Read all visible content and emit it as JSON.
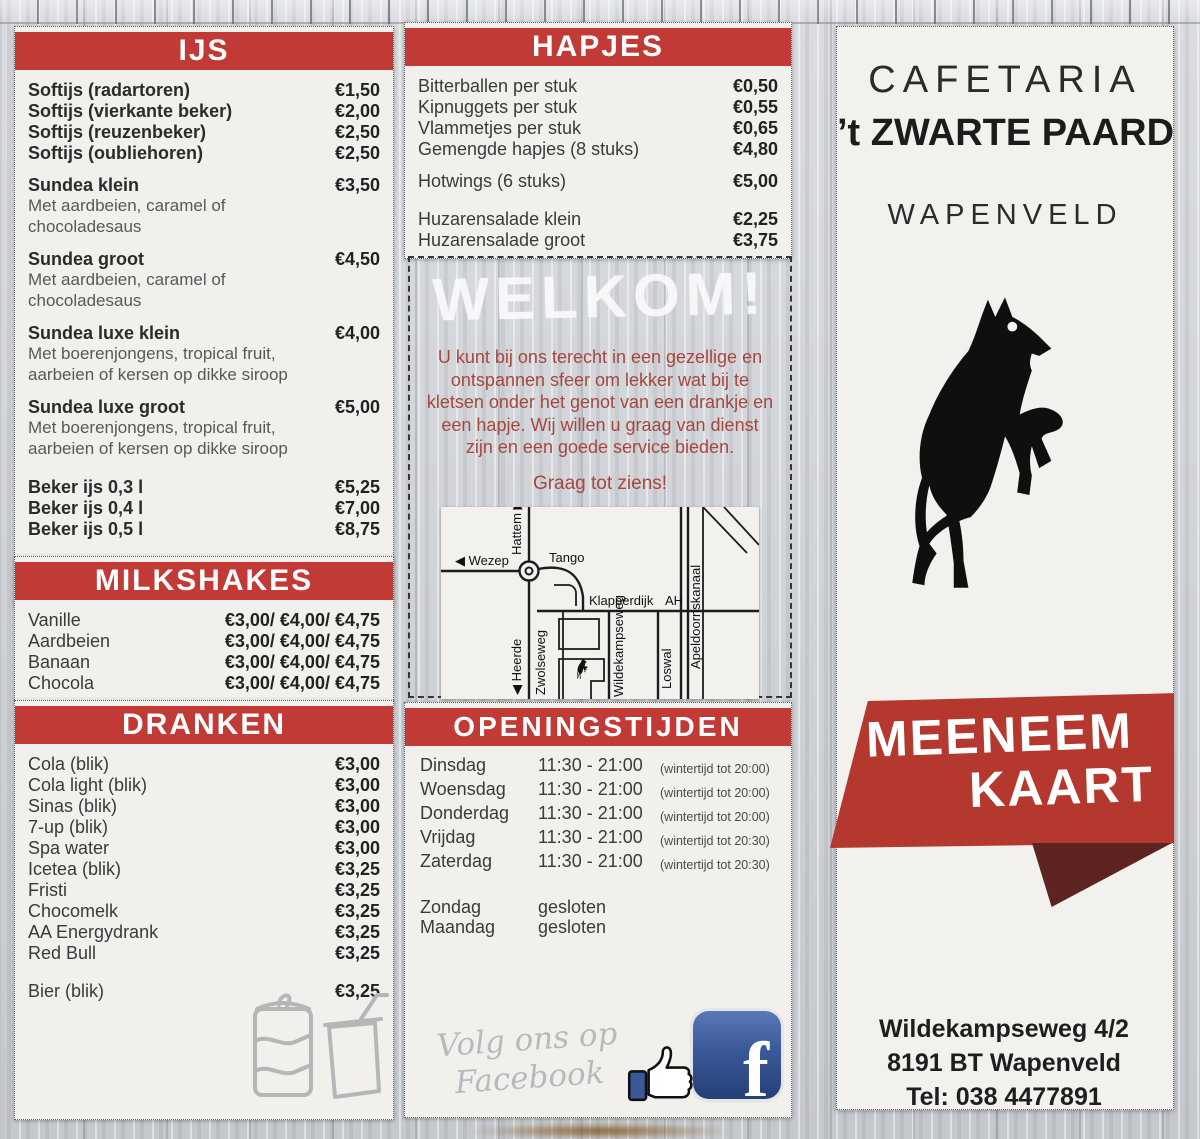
{
  "colors": {
    "header_red": "#c23a36",
    "banner_red": "#b5382f",
    "banner_fold": "#5e2421",
    "welkom_text_red": "#a6473f",
    "facebook_blue": "#3b5998"
  },
  "left": {
    "ijs": {
      "title": "IJS",
      "items": [
        {
          "name": "Softijs (radartoren)",
          "price": "€1,50"
        },
        {
          "name": "Softijs (vierkante beker)",
          "price": "€2,00"
        },
        {
          "name": "Softijs (reuzenbeker)",
          "price": "€2,50"
        },
        {
          "name": "Softijs (oubliehoren)",
          "price": "€2,50"
        },
        {
          "name": "Sundea klein",
          "price": "€3,50",
          "desc": "Met aardbeien, caramel of chocoladesaus",
          "gap": true
        },
        {
          "name": "Sundea groot",
          "price": "€4,50",
          "desc": "Met aardbeien, caramel of chocoladesaus",
          "gap": true
        },
        {
          "name": "Sundea luxe klein",
          "price": "€4,00",
          "desc": "Met boerenjongens, tropical fruit, aarbeien of kersen op dikke siroop",
          "gap": true
        },
        {
          "name": "Sundea luxe groot",
          "price": "€5,00",
          "desc": "Met boerenjongens, tropical fruit, aarbeien of kersen op dikke siroop",
          "gap": true
        },
        {
          "name": "Beker ijs 0,3 l",
          "price": "€5,25",
          "gap2": true
        },
        {
          "name": "Beker ijs 0,4 l",
          "price": "€7,00"
        },
        {
          "name": "Beker ijs 0,5 l",
          "price": "€8,75"
        },
        {
          "name": "Slagroom",
          "price": "€0,75",
          "gap2": true
        },
        {
          "name": "Spikkels/ nootjes/ chocodip",
          "price": "€0,50"
        }
      ]
    },
    "milkshakes": {
      "title": "MILKSHAKES",
      "items": [
        {
          "name": "Vanille",
          "price": "€3,00/ €4,00/ €4,75"
        },
        {
          "name": "Aardbeien",
          "price": "€3,00/ €4,00/ €4,75"
        },
        {
          "name": "Banaan",
          "price": "€3,00/ €4,00/ €4,75"
        },
        {
          "name": "Chocola",
          "price": "€3,00/ €4,00/ €4,75"
        }
      ]
    },
    "dranken": {
      "title": "DRANKEN",
      "items": [
        {
          "name": "Cola (blik)",
          "price": "€3,00"
        },
        {
          "name": "Cola light (blik)",
          "price": "€3,00"
        },
        {
          "name": "Sinas (blik)",
          "price": "€3,00"
        },
        {
          "name": "7-up (blik)",
          "price": "€3,00"
        },
        {
          "name": "Spa water",
          "price": "€3,00"
        },
        {
          "name": "Icetea (blik)",
          "price": "€3,25"
        },
        {
          "name": "Fristi",
          "price": "€3,25"
        },
        {
          "name": "Chocomelk",
          "price": "€3,25"
        },
        {
          "name": "AA Energydrank",
          "price": "€3,25"
        },
        {
          "name": "Red Bull",
          "price": "€3,25"
        },
        {
          "name": "Bier (blik)",
          "price": "€3,25",
          "gap2": true
        }
      ]
    }
  },
  "middle": {
    "hapjes": {
      "title": "HAPJES",
      "items": [
        {
          "name": "Bitterballen per stuk",
          "price": "€0,50"
        },
        {
          "name": "Kipnuggets per stuk",
          "price": "€0,55"
        },
        {
          "name": "Vlammetjes per stuk",
          "price": "€0,65"
        },
        {
          "name": "Gemengde hapjes (8 stuks)",
          "price": "€4,80"
        },
        {
          "name": "Hotwings (6 stuks)",
          "price": "€5,00",
          "gap": true
        },
        {
          "name": "Huzarensalade klein",
          "price": "€2,25",
          "gap2": true
        },
        {
          "name": "Huzarensalade groot",
          "price": "€3,75"
        }
      ]
    },
    "welkom": {
      "title": "WELKOM!",
      "body": "U kunt bij ons terecht in een gezellige en ontspannen sfeer om lekker wat bij te kletsen onder het genot van een drankje en een hapje. Wij willen u graag van dienst zijn en een goede service bieden.",
      "closing": "Graag tot ziens!"
    },
    "map": {
      "labels": {
        "hattem": "Hattem ▶",
        "wezep": "◀ Wezep",
        "tango": "Tango",
        "klapperdijk": "Klapperdijk",
        "ah": "AH",
        "apeldoornskanaal": "Apeldoornskanaal",
        "heerde": "◀ Heerde",
        "zwolseweg": "Zwolseweg",
        "wildekampseweg": "Wildekampseweg",
        "loswal": "Loswal"
      }
    },
    "openingstijden": {
      "title": "OPENINGSTIJDEN",
      "rows": [
        {
          "day": "Dinsdag",
          "time": "11:30 - 21:00",
          "note": "(wintertijd tot 20:00)"
        },
        {
          "day": "Woensdag",
          "time": "11:30 - 21:00",
          "note": "(wintertijd tot 20:00)"
        },
        {
          "day": "Donderdag",
          "time": "11:30 - 21:00",
          "note": "(wintertijd tot 20:00)"
        },
        {
          "day": "Vrijdag",
          "time": "11:30 - 21:00",
          "note": "(wintertijd tot 20:30)"
        },
        {
          "day": "Zaterdag",
          "time": "11:30 - 21:00",
          "note": "(wintertijd tot 20:30)"
        },
        {
          "day": "Zondag",
          "time": "gesloten",
          "gap2": true
        },
        {
          "day": "Maandag",
          "time": "gesloten"
        }
      ]
    },
    "facebook": {
      "line1": "Volg ons op",
      "line2": "Facebook",
      "icon_letter": "f"
    }
  },
  "right": {
    "header": {
      "line1": "CAFETARIA",
      "line2": "’t ZWARTE PAARD",
      "line3": "WAPENVELD"
    },
    "banner": {
      "line1": "MEENEEM",
      "line2": "KAART"
    },
    "address": [
      "Wildekampseweg 4/2",
      "8191 BT Wapenveld",
      "Tel: 038 4477891"
    ]
  }
}
